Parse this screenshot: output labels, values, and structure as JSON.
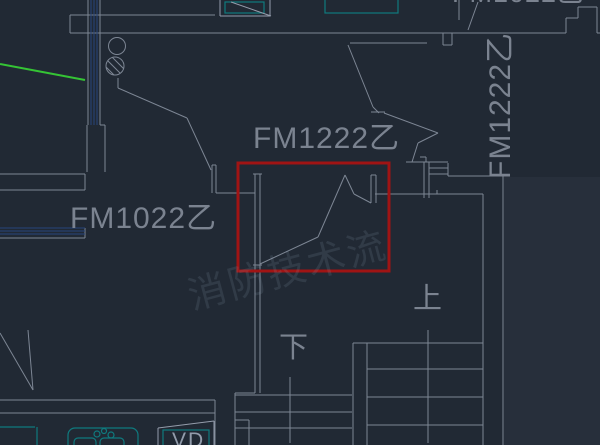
{
  "app": {
    "view": "cad-floor-plan-viewport"
  },
  "colors": {
    "bg": "#212934",
    "bgLight": "#272f3b",
    "line": "#7d8694",
    "lineBright": "#949cab",
    "hatchBlue": "#27457c",
    "teal": "#0f7a7e",
    "green": "#35c435",
    "red": "#a01414",
    "textGray": "#7b8390",
    "vdGray": "#929cab",
    "watermark": "rgba(148,168,194,0.14)"
  },
  "labels": {
    "door_left": "FM1022乙",
    "door_center": "FM1222乙",
    "door_right_vertical": "FM1222乙",
    "door_top_partial": "FM1022乙",
    "stair_up": "上",
    "stair_down": "下",
    "shaft_vd": "VD",
    "watermark": "消防技术流"
  }
}
